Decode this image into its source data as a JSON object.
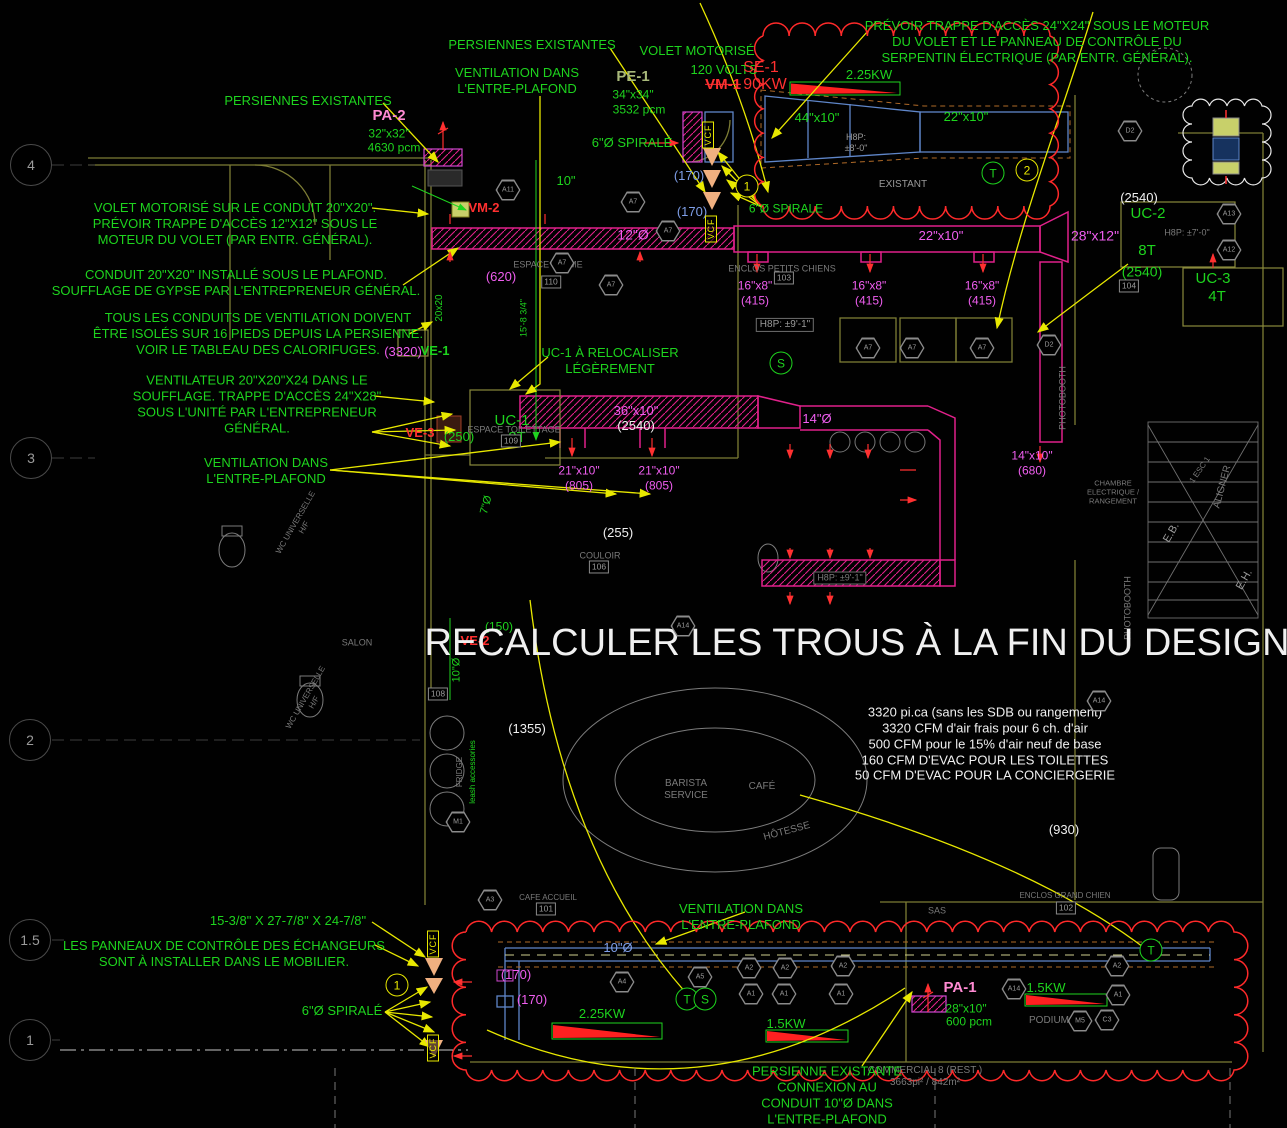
{
  "colors": {
    "g": "#1ed41e",
    "m": "#f05ef0",
    "p": "#ff8ad2",
    "b": "#7f9fe8",
    "w": "#f0f0f0",
    "r": "#ff3030",
    "y": "#e8e800",
    "gy": "#9a9a9a",
    "gy2": "#7a7a7a",
    "ol": "#a8b87a",
    "duct_magenta": "#e0218a",
    "wall_olive": "#7d7d35",
    "duct_blue": "#5f86c9",
    "cloud_red": "#ff2a2a"
  },
  "grid_bubbles": [
    {
      "label": "4",
      "x": 31,
      "y": 165
    },
    {
      "label": "3",
      "x": 31,
      "y": 458
    },
    {
      "label": "2",
      "x": 30,
      "y": 740
    },
    {
      "label": "1.5",
      "x": 30,
      "y": 940
    },
    {
      "label": "1",
      "x": 30,
      "y": 1040
    }
  ],
  "circle_tags": [
    {
      "t": "1",
      "x": 747,
      "y": 186,
      "c": "y"
    },
    {
      "t": "2",
      "x": 1027,
      "y": 170,
      "c": "y"
    },
    {
      "t": "1",
      "x": 397,
      "y": 985,
      "c": "y"
    },
    {
      "t": "T",
      "x": 993,
      "y": 173,
      "c": "g"
    },
    {
      "t": "S",
      "x": 781,
      "y": 363,
      "c": "g"
    },
    {
      "t": "T",
      "x": 687,
      "y": 999,
      "c": "g"
    },
    {
      "t": "S",
      "x": 705,
      "y": 999,
      "c": "g"
    },
    {
      "t": "T",
      "x": 1151,
      "y": 950,
      "c": "g"
    }
  ],
  "vcf_tags": [
    {
      "t": "VCF",
      "x": 708,
      "y": 135
    },
    {
      "t": "VCF",
      "x": 711,
      "y": 229
    },
    {
      "t": "VCF",
      "x": 433,
      "y": 944
    },
    {
      "t": "VCF",
      "x": 433,
      "y": 1048
    }
  ],
  "room_tags": [
    {
      "t": "110",
      "x": 551,
      "y": 282
    },
    {
      "t": "103",
      "x": 784,
      "y": 278
    },
    {
      "t": "109",
      "x": 511,
      "y": 441
    },
    {
      "t": "106",
      "x": 599,
      "y": 567
    },
    {
      "t": "104",
      "x": 1129,
      "y": 286
    },
    {
      "t": "108",
      "x": 438,
      "y": 694
    },
    {
      "t": "101",
      "x": 546,
      "y": 909
    },
    {
      "t": "102",
      "x": 1066,
      "y": 908
    }
  ],
  "hex_tags": [
    {
      "t": "A11",
      "x": 508,
      "y": 190
    },
    {
      "t": "A7",
      "x": 633,
      "y": 202
    },
    {
      "t": "A7",
      "x": 562,
      "y": 263
    },
    {
      "t": "A7",
      "x": 611,
      "y": 285
    },
    {
      "t": "A7",
      "x": 668,
      "y": 231
    },
    {
      "t": "A7",
      "x": 868,
      "y": 348
    },
    {
      "t": "A7",
      "x": 912,
      "y": 348
    },
    {
      "t": "A7",
      "x": 982,
      "y": 348
    },
    {
      "t": "D2",
      "x": 1049,
      "y": 345
    },
    {
      "t": "D2",
      "x": 1130,
      "y": 131
    },
    {
      "t": "A13",
      "x": 1229,
      "y": 214
    },
    {
      "t": "A12",
      "x": 1229,
      "y": 250
    },
    {
      "t": "A14",
      "x": 1099,
      "y": 701
    },
    {
      "t": "A14",
      "x": 683,
      "y": 626
    },
    {
      "t": "A14",
      "x": 1014,
      "y": 989
    },
    {
      "t": "M5",
      "x": 1080,
      "y": 1021
    },
    {
      "t": "C3",
      "x": 1107,
      "y": 1020
    },
    {
      "t": "A4",
      "x": 622,
      "y": 982
    },
    {
      "t": "A5",
      "x": 700,
      "y": 977
    },
    {
      "t": "A2",
      "x": 749,
      "y": 968
    },
    {
      "t": "A2",
      "x": 785,
      "y": 968
    },
    {
      "t": "A2",
      "x": 843,
      "y": 966
    },
    {
      "t": "A1",
      "x": 751,
      "y": 994
    },
    {
      "t": "A1",
      "x": 784,
      "y": 994
    },
    {
      "t": "A1",
      "x": 841,
      "y": 994
    },
    {
      "t": "A2",
      "x": 1117,
      "y": 966
    },
    {
      "t": "A1",
      "x": 1118,
      "y": 995
    },
    {
      "t": "A3",
      "x": 490,
      "y": 900
    },
    {
      "t": "M1",
      "x": 458,
      "y": 822
    }
  ],
  "labels": [
    {
      "n": "note-trappe-24",
      "t": "PRÉVOIR TRAPPE D'ACCÈS 24\"X24\" SOUS LE MOTEUR\nDU VOLET ET LE PANNEAU DE CONTRÔLE DU\nSERPENTIN ÉLECTRIQUE (PAR ENTR. GÉNÉRAL).",
      "x": 1037,
      "y": 42,
      "c": "g",
      "s": 13
    },
    {
      "n": "persiennes-existantes-top",
      "t": "PERSIENNES EXISTANTES",
      "x": 532,
      "y": 45,
      "c": "g",
      "s": 13
    },
    {
      "n": "volet-motorise",
      "t": "VOLET MOTORISÉ",
      "x": 697,
      "y": 51,
      "c": "g",
      "s": 13
    },
    {
      "n": "volet-120v",
      "t": "120 VOLTS",
      "x": 724,
      "y": 70,
      "c": "g",
      "s": 13
    },
    {
      "n": "ventilation-entreplafond-top",
      "t": "VENTILATION DANS\nL'ENTRE-PLAFOND",
      "x": 517,
      "y": 81,
      "c": "g",
      "s": 13
    },
    {
      "n": "persiennes-existantes-left",
      "t": "PERSIENNES EXISTANTES",
      "x": 308,
      "y": 101,
      "c": "g",
      "s": 13
    },
    {
      "n": "pe1",
      "t": "PE-1",
      "x": 633,
      "y": 77,
      "c": "ol",
      "s": 15,
      "w": 1
    },
    {
      "n": "pe1-size",
      "t": "34\"x34\"",
      "x": 633,
      "y": 95,
      "c": "g",
      "s": 12
    },
    {
      "n": "pe1-cfm",
      "t": "3532 pcm",
      "x": 639,
      "y": 110,
      "c": "g",
      "s": 12
    },
    {
      "n": "se1",
      "t": "SE-1",
      "x": 761,
      "y": 68,
      "c": "r",
      "s": 16
    },
    {
      "n": "vm1",
      "t": "VM-1",
      "x": 723,
      "y": 85,
      "c": "r",
      "s": 15,
      "w": 1,
      "st": 1
    },
    {
      "n": "kw90",
      "t": "90KW",
      "x": 765,
      "y": 85,
      "c": "r",
      "s": 16
    },
    {
      "n": "kw-225-top",
      "t": "2.25KW",
      "x": 869,
      "y": 75,
      "c": "g",
      "s": 13
    },
    {
      "n": "size-44x10",
      "t": "44\"x10\"",
      "x": 817,
      "y": 118,
      "c": "g",
      "s": 13
    },
    {
      "n": "size-22x10-top",
      "t": "22\"x10\"",
      "x": 966,
      "y": 117,
      "c": "g",
      "s": 13
    },
    {
      "n": "hsp-8-0",
      "t": "H8P:\n±8'-0\"",
      "x": 856,
      "y": 143,
      "c": "gy",
      "s": 9
    },
    {
      "n": "existant",
      "t": "EXISTANT",
      "x": 903,
      "y": 185,
      "c": "gy",
      "s": 10
    },
    {
      "n": "spirale-6-top",
      "t": "6\"Ø SPIRALÉ",
      "x": 632,
      "y": 143,
      "c": "g",
      "s": 13
    },
    {
      "n": "pa2",
      "t": "PA-2",
      "x": 389,
      "y": 116,
      "c": "p",
      "s": 15,
      "w": 1
    },
    {
      "n": "pa2-size",
      "t": "32\"x32\"",
      "x": 389,
      "y": 134,
      "c": "g",
      "s": 12
    },
    {
      "n": "pa2-cfm",
      "t": "4630 pcm",
      "x": 394,
      "y": 148,
      "c": "g",
      "s": 12
    },
    {
      "n": "note-volet-conduit",
      "t": "VOLET MOTORISÉ SUR LE CONDUIT 20\"X20\".\nPRÉVOIR TRAPPE D'ACCÈS 12\"X12\" SOUS LE\nMOTEUR DU VOLET (PAR ENTR. GÉNÉRAL).",
      "x": 235,
      "y": 224,
      "c": "g",
      "s": 13
    },
    {
      "n": "vm2",
      "t": "VM-2",
      "x": 484,
      "y": 208,
      "c": "r",
      "s": 13,
      "w": 1
    },
    {
      "n": "note-conduit-2020",
      "t": "CONDUIT 20\"X20\" INSTALLÉ SOUS LE PLAFOND.\nSOUFFLAGE DE GYPSE PAR L'ENTREPRENEUR GÉNÉRAL.",
      "x": 236,
      "y": 283,
      "c": "g",
      "s": 13
    },
    {
      "n": "note-tous-conduits",
      "t": "TOUS LES CONDUITS DE VENTILATION DOIVENT\nÊTRE ISOLÉS SUR 16 PIEDS DEPUIS LA PERSIENNE.\nVOIR LE TABLEAU DES CALORIFUGES.",
      "x": 258,
      "y": 334,
      "c": "g",
      "s": 13
    },
    {
      "n": "note-ventilateur",
      "t": "VENTILATEUR 20\"X20\"X24 DANS LE\nSOUFFLAGE. TRAPPE D'ACCÈS 24\"X28\"\nSOUS L'UNITÉ PAR L'ENTREPRENEUR\nGÉNÉRAL.",
      "x": 257,
      "y": 404,
      "c": "g",
      "s": 13
    },
    {
      "n": "ventilation-entreplafond-left",
      "t": "VENTILATION DANS\nL'ENTRE-PLAFOND",
      "x": 266,
      "y": 471,
      "c": "g",
      "s": 13
    },
    {
      "n": "d3320",
      "t": "(3320)",
      "x": 403,
      "y": 352,
      "c": "m",
      "s": 13
    },
    {
      "n": "ve1",
      "t": "VE-1",
      "x": 435,
      "y": 351,
      "c": "g",
      "s": 13,
      "w": 1
    },
    {
      "n": "ve3",
      "t": "VE-3",
      "x": 420,
      "y": 433,
      "c": "r",
      "s": 13,
      "w": 1
    },
    {
      "n": "ve3-250",
      "t": "(250)",
      "x": 459,
      "y": 437,
      "c": "g",
      "s": 13
    },
    {
      "n": "uc1-reloc",
      "t": "UC-1 À RELOCALISER\nLÉGÈREMENT",
      "x": 610,
      "y": 361,
      "c": "g",
      "s": 13
    },
    {
      "n": "uc1",
      "t": "UC-1",
      "x": 512,
      "y": 421,
      "c": "g",
      "s": 15
    },
    {
      "n": "uc1-8t",
      "t": "8T",
      "x": 517,
      "y": 438,
      "c": "g",
      "s": 15
    },
    {
      "n": "espace-toilettage",
      "t": "ESPACE TOILETTAGE",
      "x": 514,
      "y": 430,
      "c": "gy2",
      "s": 9
    },
    {
      "n": "dim-10in",
      "t": "10\"",
      "x": 566,
      "y": 181,
      "c": "g",
      "s": 13
    },
    {
      "n": "b170-a",
      "t": "(170)",
      "x": 689,
      "y": 176,
      "c": "b",
      "s": 13
    },
    {
      "n": "b170-b",
      "t": "(170)",
      "x": 692,
      "y": 212,
      "c": "b",
      "s": 13
    },
    {
      "n": "spirale-6-mid",
      "t": "6\"Ø SPIRALE",
      "x": 786,
      "y": 209,
      "c": "g",
      "s": 12
    },
    {
      "n": "d12o",
      "t": "12\"Ø",
      "x": 633,
      "y": 235,
      "c": "m",
      "s": 14
    },
    {
      "n": "d620",
      "t": "(620)",
      "x": 501,
      "y": 277,
      "c": "m",
      "s": 13
    },
    {
      "n": "espace-calme",
      "t": "ESPACE CALME",
      "x": 548,
      "y": 265,
      "c": "gy2",
      "s": 9
    },
    {
      "n": "enclos-petits-chiens",
      "t": "ENCLOS PETITS CHIENS",
      "x": 782,
      "y": 269,
      "c": "gy2",
      "s": 9
    },
    {
      "n": "d22x10-mid",
      "t": "22\"x10\"",
      "x": 941,
      "y": 236,
      "c": "m",
      "s": 13
    },
    {
      "n": "d16x8-a",
      "t": "16\"x8\"\n(415)",
      "x": 755,
      "y": 293,
      "c": "m",
      "s": 12
    },
    {
      "n": "d16x8-b",
      "t": "16\"x8\"\n(415)",
      "x": 869,
      "y": 293,
      "c": "m",
      "s": 12
    },
    {
      "n": "d16x8-c",
      "t": "16\"x8\"\n(415)",
      "x": 982,
      "y": 293,
      "c": "m",
      "s": 12
    },
    {
      "n": "hsp-9-1",
      "t": "H8P: ±9'-1\"",
      "x": 785,
      "y": 325,
      "c": "gy",
      "s": 10,
      "bx": 1
    },
    {
      "n": "w2540-tr",
      "t": "(2540)",
      "x": 1139,
      "y": 198,
      "c": "w",
      "s": 13
    },
    {
      "n": "uc2",
      "t": "UC-2",
      "x": 1148,
      "y": 214,
      "c": "g",
      "s": 15
    },
    {
      "n": "d28x12",
      "t": "28\"x12\"",
      "x": 1095,
      "y": 236,
      "c": "m",
      "s": 14
    },
    {
      "n": "uc2-8t",
      "t": "8T",
      "x": 1147,
      "y": 251,
      "c": "g",
      "s": 15
    },
    {
      "n": "uc2-2540",
      "t": "(2540)",
      "x": 1142,
      "y": 272,
      "c": "g",
      "s": 14
    },
    {
      "n": "hsp-7-0",
      "t": "H8P: ±7'-0\"",
      "x": 1187,
      "y": 233,
      "c": "gy2",
      "s": 9
    },
    {
      "n": "uc3",
      "t": "UC-3",
      "x": 1213,
      "y": 279,
      "c": "g",
      "s": 15
    },
    {
      "n": "uc3-4t",
      "t": "4T",
      "x": 1217,
      "y": 297,
      "c": "g",
      "s": 15
    },
    {
      "n": "dim-2020",
      "t": "20x20",
      "x": 440,
      "y": 308,
      "c": "g",
      "s": 10,
      "r": -90
    },
    {
      "n": "dim-15-8",
      "t": "15'-8 3/4\"",
      "x": 524,
      "y": 318,
      "c": "g",
      "s": 9,
      "r": -90
    },
    {
      "n": "d36x10",
      "t": "36\"x10\"",
      "x": 636,
      "y": 411,
      "c": "m",
      "s": 13
    },
    {
      "n": "w2540-mid",
      "t": "(2540)",
      "x": 636,
      "y": 426,
      "c": "w",
      "s": 13
    },
    {
      "n": "d14o",
      "t": "14\"Ø",
      "x": 817,
      "y": 419,
      "c": "m",
      "s": 13
    },
    {
      "n": "d21x10-a",
      "t": "21\"x10\"\n(805)",
      "x": 579,
      "y": 478,
      "c": "m",
      "s": 12
    },
    {
      "n": "d21x10-b",
      "t": "21\"x10\"\n(805)",
      "x": 659,
      "y": 478,
      "c": "m",
      "s": 12
    },
    {
      "n": "d14x10",
      "t": "14\"x10\"\n(680)",
      "x": 1032,
      "y": 463,
      "c": "m",
      "s": 12
    },
    {
      "n": "w255",
      "t": "(255)",
      "x": 618,
      "y": 533,
      "c": "w",
      "s": 13
    },
    {
      "n": "couloir",
      "t": "COULOIR",
      "x": 600,
      "y": 556,
      "c": "gy2",
      "s": 9
    },
    {
      "n": "dim-7o",
      "t": "7\"Ø",
      "x": 487,
      "y": 505,
      "c": "g",
      "s": 11,
      "r": -75
    },
    {
      "n": "chambre-elec",
      "t": "CHAMBRE\nELECTRIQUE /\nRANGEMENT",
      "x": 1113,
      "y": 492,
      "c": "gy2",
      "s": 7.5
    },
    {
      "n": "eb",
      "t": "E.B.",
      "x": 1172,
      "y": 533,
      "c": "gy",
      "s": 11,
      "r": -60
    },
    {
      "n": "eh",
      "t": "E.H.",
      "x": 1245,
      "y": 580,
      "c": "gy",
      "s": 11,
      "r": -60
    },
    {
      "n": "aligner",
      "t": "ALIGNER",
      "x": 1223,
      "y": 487,
      "c": "gy2",
      "s": 10,
      "r": -75
    },
    {
      "n": "esc1",
      "t": "1 ESC 1",
      "x": 1200,
      "y": 470,
      "c": "gy2",
      "s": 8,
      "r": -55
    },
    {
      "n": "photobooth-a",
      "t": "PHOTOBOOTH",
      "x": 1063,
      "y": 398,
      "c": "gy2",
      "s": 9,
      "r": -90
    },
    {
      "n": "photobooth-b",
      "t": "PHOTOBOOTH",
      "x": 1128,
      "y": 608,
      "c": "gy2",
      "s": 9,
      "r": -90
    },
    {
      "n": "wc-universelle-a",
      "t": "WC UNIVERSELLE\nH/F",
      "x": 300,
      "y": 525,
      "c": "gy2",
      "s": 8,
      "r": -60
    },
    {
      "n": "wc-universelle-b",
      "t": "WC UNIVERSELLE\nH/F",
      "x": 310,
      "y": 700,
      "c": "gy2",
      "s": 8,
      "r": -60
    },
    {
      "n": "salon",
      "t": "SALON",
      "x": 357,
      "y": 643,
      "c": "gy2",
      "s": 9
    },
    {
      "n": "v150",
      "t": "(150)",
      "x": 499,
      "y": 627,
      "c": "g",
      "s": 12
    },
    {
      "n": "ve2",
      "t": "VE-2",
      "x": 475,
      "y": 641,
      "c": "r",
      "s": 13,
      "w": 1
    },
    {
      "n": "dim-10o-vert",
      "t": "10\"Ø",
      "x": 457,
      "y": 670,
      "c": "g",
      "s": 11,
      "r": -90
    },
    {
      "n": "big-note",
      "t": "RECALCULER LES TROUS À LA FIN DU DESIGN",
      "x": 857,
      "y": 643,
      "c": "w",
      "s": 38
    },
    {
      "n": "w1355",
      "t": "(1355)",
      "x": 527,
      "y": 729,
      "c": "w",
      "s": 13
    },
    {
      "n": "fridge",
      "t": "FRIDGE",
      "x": 460,
      "y": 772,
      "c": "gy2",
      "s": 8,
      "r": -90
    },
    {
      "n": "leash-accessories",
      "t": "leash accessories",
      "x": 473,
      "y": 772,
      "c": "g",
      "s": 8,
      "r": -90
    },
    {
      "n": "barista-service",
      "t": "BARISTA\nSERVICE",
      "x": 686,
      "y": 790,
      "c": "gy2",
      "s": 10
    },
    {
      "n": "cafe",
      "t": "CAFÉ",
      "x": 762,
      "y": 787,
      "c": "gy2",
      "s": 10
    },
    {
      "n": "hotesse",
      "t": "HÔTESSE",
      "x": 787,
      "y": 832,
      "c": "gy2",
      "s": 10,
      "r": -15
    },
    {
      "n": "info-block",
      "t": "3320 pi.ca (sans les SDB ou rangement)\n3320 CFM d'air frais pour 6 ch. d'air\n500 CFM pour le 15% d'air neuf de base\n160 CFM D'EVAC POUR LES TOILETTES\n50 CFM D'EVAC POUR LA CONCIERGERIE",
      "x": 985,
      "y": 744,
      "c": "w",
      "s": 13
    },
    {
      "n": "w930",
      "t": "(930)",
      "x": 1064,
      "y": 830,
      "c": "w",
      "s": 13
    },
    {
      "n": "enclos-grand-chien",
      "t": "ENCLOS GRAND CHIEN",
      "x": 1065,
      "y": 896,
      "c": "gy2",
      "s": 8
    },
    {
      "n": "sas",
      "t": "SAS",
      "x": 937,
      "y": 911,
      "c": "gy2",
      "s": 9
    },
    {
      "n": "cafe-accueil",
      "t": "CAFE ACCUEIL",
      "x": 548,
      "y": 898,
      "c": "gy2",
      "s": 8
    },
    {
      "n": "dim-echangeur",
      "t": "15-3/8\" X 27-7/8\" X 24-7/8\"",
      "x": 288,
      "y": 921,
      "c": "g",
      "s": 13
    },
    {
      "n": "note-panneaux",
      "t": "LES PANNEAUX DE CONTRÔLE DES ÉCHANGEURS\nSONT À INSTALLER DANS LE MOBILIER.",
      "x": 224,
      "y": 954,
      "c": "g",
      "s": 13
    },
    {
      "n": "spirale-6-bottom",
      "t": "6\"Ø SPIRALÉ",
      "x": 342,
      "y": 1011,
      "c": "g",
      "s": 13
    },
    {
      "n": "ventilation-entreplafond-bottom",
      "t": "VENTILATION DANS\nL'ENTRE-PLAFOND",
      "x": 741,
      "y": 917,
      "c": "g",
      "s": 13
    },
    {
      "n": "b10o",
      "t": "10\"Ø",
      "x": 618,
      "y": 948,
      "c": "b",
      "s": 13
    },
    {
      "n": "d170-c",
      "t": "(170)",
      "x": 516,
      "y": 975,
      "c": "m",
      "s": 13
    },
    {
      "n": "d170-d",
      "t": "(170)",
      "x": 532,
      "y": 1000,
      "c": "m",
      "s": 13
    },
    {
      "n": "kw-225-bottom",
      "t": "2.25KW",
      "x": 602,
      "y": 1014,
      "c": "g",
      "s": 13
    },
    {
      "n": "kw-15-mid",
      "t": "1.5KW",
      "x": 786,
      "y": 1024,
      "c": "g",
      "s": 13
    },
    {
      "n": "kw-15-right",
      "t": "1.5KW",
      "x": 1046,
      "y": 988,
      "c": "g",
      "s": 13
    },
    {
      "n": "pa1",
      "t": "PA-1",
      "x": 960,
      "y": 988,
      "c": "p",
      "s": 15,
      "w": 1
    },
    {
      "n": "pa1-size",
      "t": "28\"x10\"",
      "x": 966,
      "y": 1009,
      "c": "g",
      "s": 12
    },
    {
      "n": "pa1-cfm",
      "t": "600 pcm",
      "x": 969,
      "y": 1022,
      "c": "g",
      "s": 12
    },
    {
      "n": "podium",
      "t": "PODIUM",
      "x": 1049,
      "y": 1021,
      "c": "gy2",
      "s": 10
    },
    {
      "n": "commercial-8",
      "t": "COMMERCIAL 8 (REST )\n3663pi² / 842m²",
      "x": 925,
      "y": 1077,
      "c": "gy2",
      "s": 10
    },
    {
      "n": "note-persienne-bottom",
      "t": "PERSIENNE EXISTANTE\nCONNEXION AU\nCONDUIT 10\"Ø DANS\nL'ENTRE-PLAFOND",
      "x": 827,
      "y": 1095,
      "c": "g",
      "s": 13
    },
    {
      "n": "hsp-9-1b",
      "t": "H8P: ±9'-1\"",
      "x": 840,
      "y": 578,
      "c": "gy2",
      "s": 9,
      "bx": 1
    }
  ]
}
